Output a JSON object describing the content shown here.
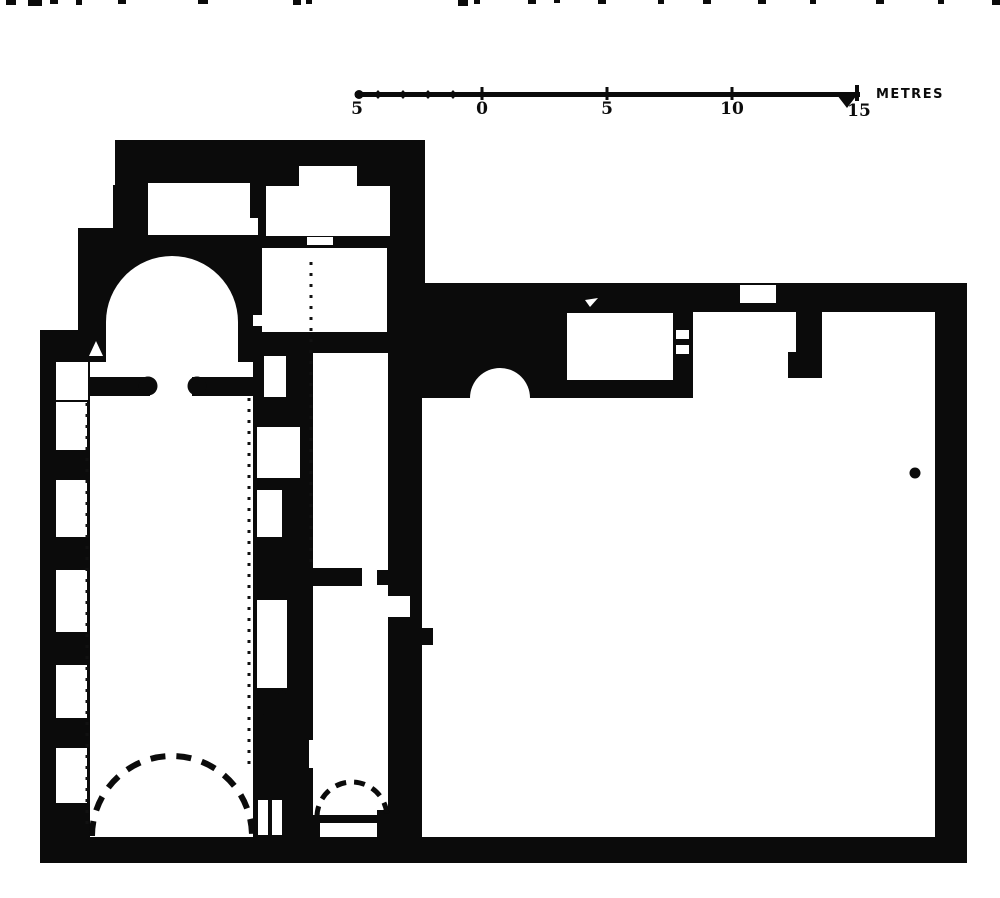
{
  "scale_bar": {
    "labels": [
      "5",
      "0",
      "5",
      "10",
      "15"
    ],
    "unit_label": "METRES",
    "metres_per_major_tick": 5
  },
  "colors": {
    "ink": "#0b0b0b",
    "paper": "#ffffff"
  },
  "plan_features": [
    "apse-with-semidome",
    "nave-with-wall-bays",
    "dashed-vault-arc-nave",
    "side-corridor",
    "dashed-vault-arc-corridor",
    "north-rooms",
    "great-hall",
    "semicircular-niche",
    "wall-chamber",
    "door-gaps",
    "pier",
    "survey-dot"
  ]
}
